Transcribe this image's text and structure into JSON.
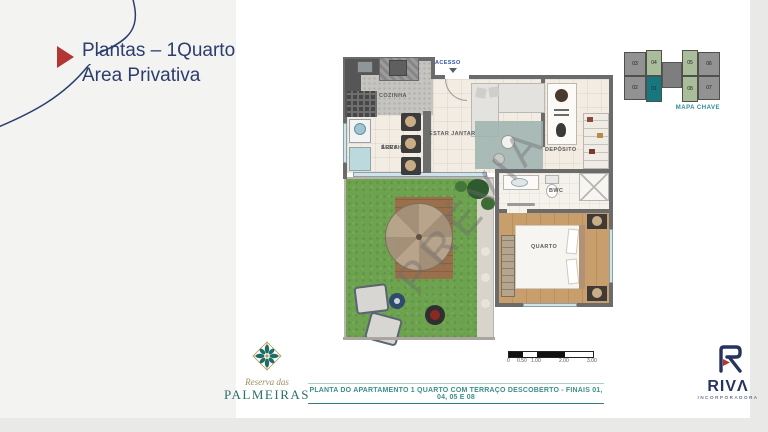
{
  "slide": {
    "title_line1": "Plantas – 1Quarto",
    "title_line2": "Área Privativa"
  },
  "map_key": {
    "label": "MAPA CHAVE",
    "units": {
      "u03": "03",
      "u04": "04",
      "u05": "05",
      "u06": "06",
      "u02": "02",
      "u01": "01",
      "u08": "08",
      "u07": "07"
    },
    "highlighted_unit": "01",
    "highlight_color": "#17777e",
    "variant_color": "#a9bd9a",
    "base_color": "#929292"
  },
  "plan": {
    "watermark": "PRÉVIA",
    "labels": {
      "access": "ACESSO",
      "kitchen": "COZINHA",
      "service_1": "ÁREA",
      "service_2": "SERVIÇO",
      "living": "ESTAR JANTAR",
      "storage": "DEPÓSITO",
      "bathroom": "BWC",
      "bedroom": "QUARTO"
    }
  },
  "scale_bar": {
    "ticks": [
      "0",
      "0.50",
      "1.00",
      "2.00",
      "3.00"
    ]
  },
  "caption": {
    "text": "PLANTA DO APARTAMENTO 1 QUARTO COM TERRAÇO DESCOBERTO - FINAIS 01, 04, 05 E 08"
  },
  "brand": {
    "script": "Reserva das",
    "name": "PALMEIRAS"
  },
  "developer": {
    "name": "RIVΛ",
    "tagline": "INCORPORADORA"
  },
  "colors": {
    "title_navy": "#2d3e6d",
    "accent_red": "#b23734",
    "teal": "#2e8c94",
    "caption_teal": "#3a8f88",
    "grass_green": "#6da34f",
    "wall_gray": "#6b6b6b"
  }
}
